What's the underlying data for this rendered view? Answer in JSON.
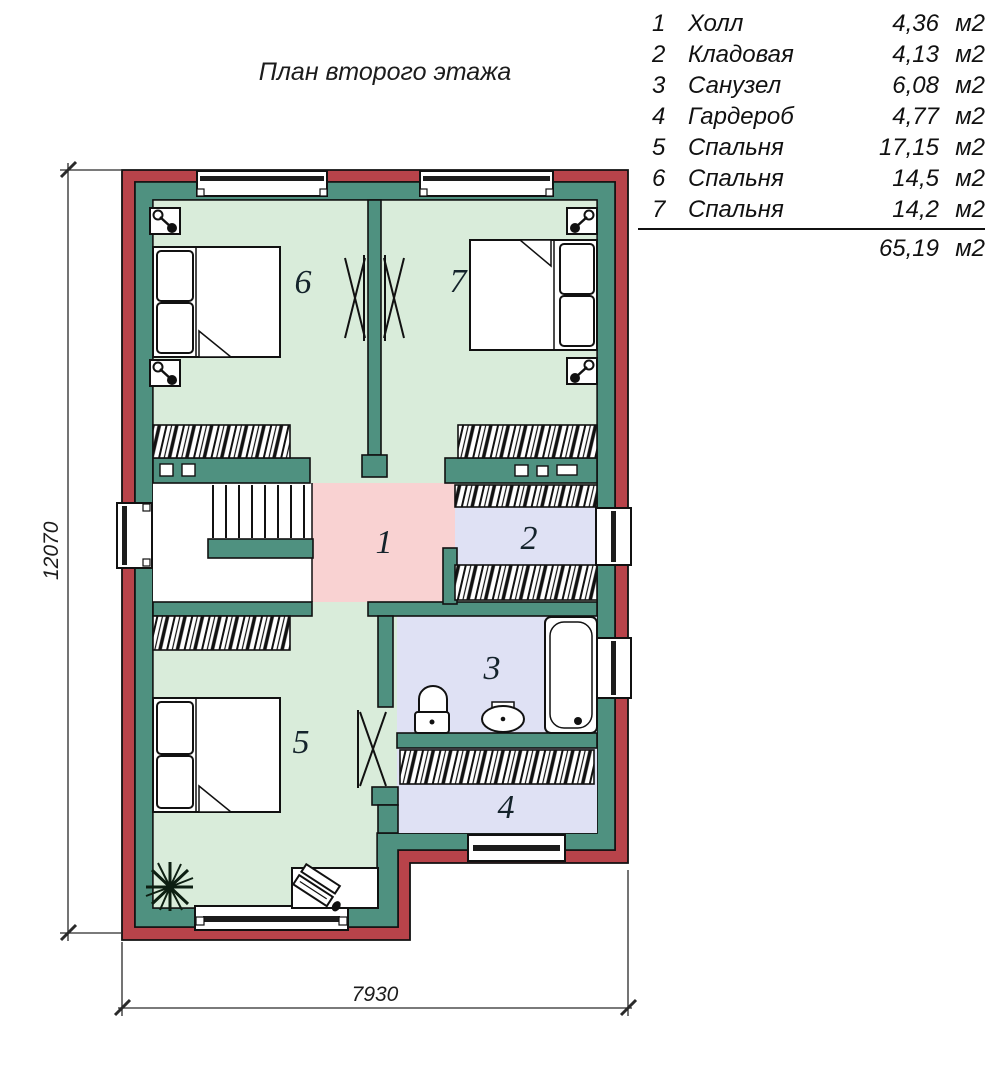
{
  "title": "План второго этажа",
  "legend": {
    "rows": [
      {
        "num": "1",
        "name": "Холл",
        "area": "4,36",
        "unit": "м2"
      },
      {
        "num": "2",
        "name": "Кладовая",
        "area": "4,13",
        "unit": "м2"
      },
      {
        "num": "3",
        "name": "Санузел",
        "area": "6,08",
        "unit": "м2"
      },
      {
        "num": "4",
        "name": "Гардероб",
        "area": "4,77",
        "unit": "м2"
      },
      {
        "num": "5",
        "name": "Спальня",
        "area": "17,15",
        "unit": "м2"
      },
      {
        "num": "6",
        "name": "Спальня",
        "area": "14,5",
        "unit": "м2"
      },
      {
        "num": "7",
        "name": "Спальня",
        "area": "14,2",
        "unit": "м2"
      }
    ],
    "total_area": "65,19",
    "total_unit": "м2"
  },
  "plan": {
    "room_labels": {
      "r1": "1",
      "r2": "2",
      "r3": "3",
      "r4": "4",
      "r5": "5",
      "r6": "6",
      "r7": "7"
    }
  },
  "dimensions": {
    "height": "12070",
    "width": "7930"
  },
  "colors": {
    "exterior_wall": "#b8434a",
    "interior_wall": "#4f9180",
    "bedroom_floor": "#d9ecda",
    "wet_room_floor": "#dfe1f4",
    "hall_floor": "#f9d2d2",
    "line": "#111111"
  }
}
